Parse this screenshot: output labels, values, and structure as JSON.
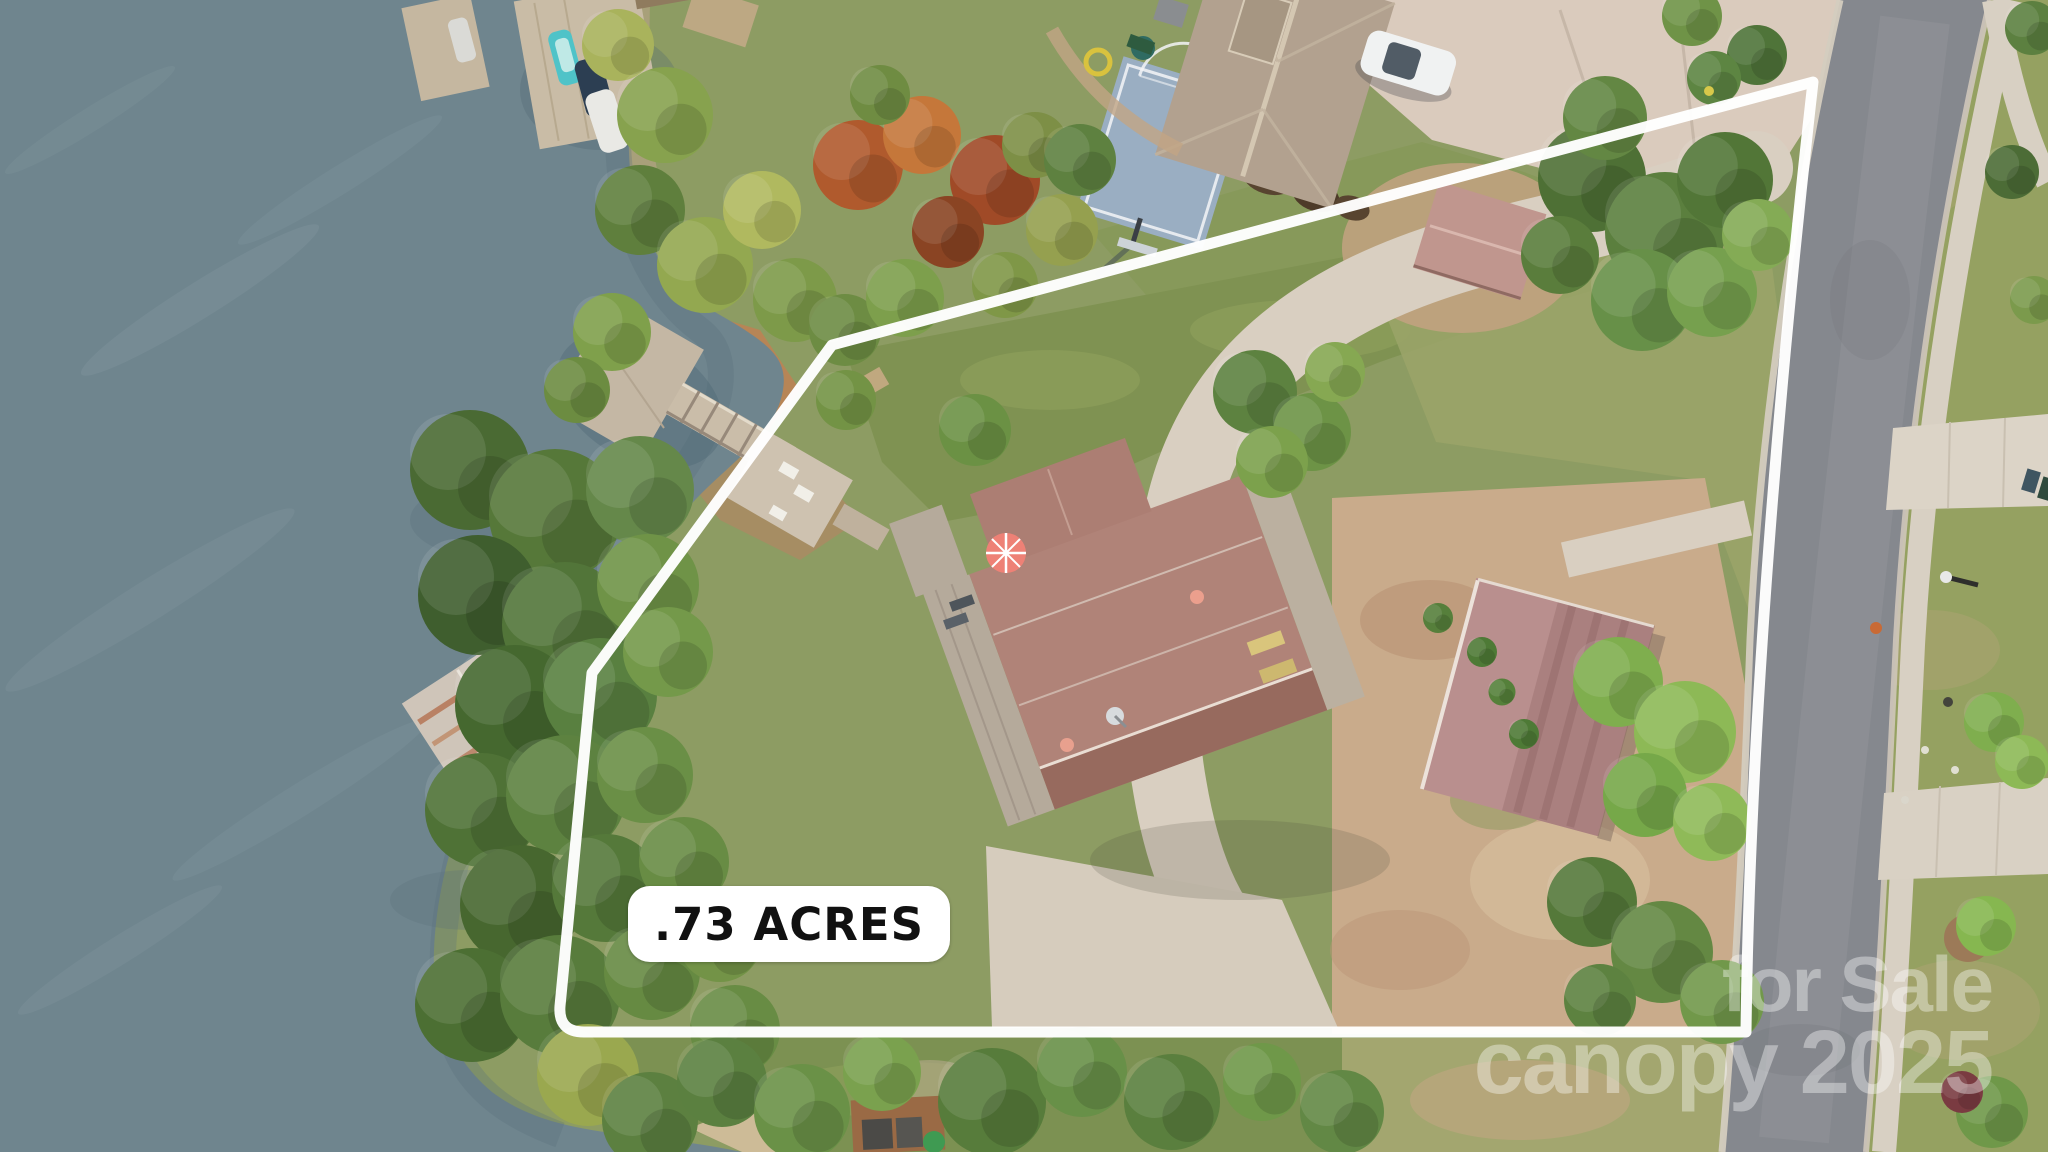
{
  "overlays": {
    "acreage_label": ".73 ACRES",
    "watermark_line1": "for Sale",
    "watermark_line2": "canopy 2025"
  },
  "colors": {
    "boundary_line": "#ffffff",
    "label_background": "#ffffff",
    "label_text": "#111111",
    "watermark_text": "#ffffff",
    "lake_water": "#6f858e",
    "forest_green": "#53763b",
    "lawn_green": "#7f9252",
    "scrub_grass": "#9aa468",
    "bare_dirt": "#c9ab8b",
    "concrete_driveway": "#d9cfc1",
    "asphalt_road": "#85888e",
    "sidewalk": "#d8d0c3",
    "main_house_roof": "#b08378",
    "guest_house_roof": "#b98f8e",
    "neighbor_house_roof": "#b2a18f",
    "pink_shed_roof": "#c0968e",
    "basketball_court": "#9aaec2",
    "patio_umbrella": "#ee8176",
    "dock_wood": "#c6b9a7",
    "boathouse_rust": "#b4714f"
  }
}
